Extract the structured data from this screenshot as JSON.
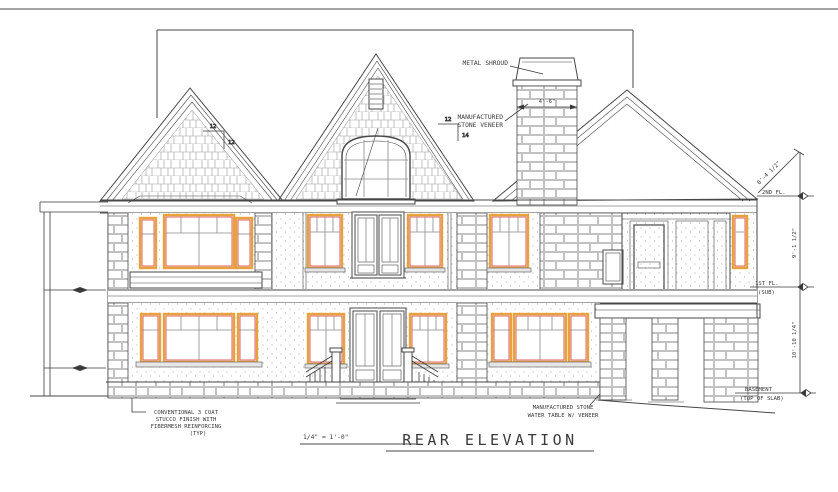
{
  "drawing": {
    "title": "REAR ELEVATION",
    "scale": "1/4\" = 1'-0\""
  },
  "annotations": {
    "metal_shroud": "METAL SHROUD",
    "stone_veneer": [
      "MANUFACTURED",
      "STONE VENEER"
    ],
    "stucco_note": [
      "CONVENTIONAL 3 COAT",
      "STUCCO FINISH WITH",
      "FIBERMESH REINFORCING",
      "(TYP)"
    ],
    "water_table_note": [
      "MANUFACTURED STONE",
      "WATER TABLE W/ VENEER"
    ]
  },
  "dimensions": {
    "chimney_width": "4'-6\"",
    "roof_slope": "8'-4 1/2\"",
    "second_to_first": "9'-1 1/2\"",
    "first_to_basement": "10'-10 1/4\"",
    "pitch_left": {
      "run": "12",
      "rise": "12"
    },
    "pitch_center": {
      "run": "12",
      "rise": "14"
    }
  },
  "levels": {
    "second_floor": "2ND FL.",
    "first_floor": [
      "1ST FL.",
      "(SUB)"
    ],
    "basement": [
      "BASEMENT",
      "(TOP OF SLAB)"
    ]
  },
  "colors": {
    "line": "#474747",
    "window_frame": "#e8a23c",
    "window_accent": "#d9534f",
    "screen_red": "#c25d58",
    "texture": "#9a9a9a",
    "paper": "#ffffff"
  }
}
